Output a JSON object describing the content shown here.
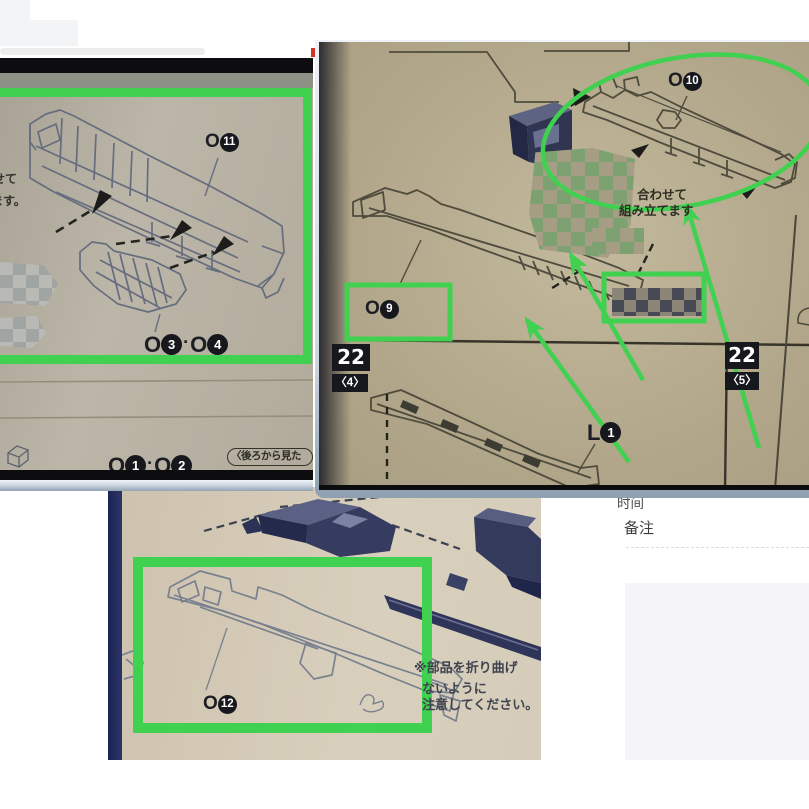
{
  "annotation_color": "#3fd14f",
  "page_bg": {
    "left_column": {
      "emoji_icon": "☺",
      "send_label": "发送讯",
      "shortcut_label": "按 Sh"
    },
    "right_column": {
      "time_label": "时间",
      "remark_label": "备注"
    }
  },
  "left_panel": {
    "o11_label": {
      "prefix": "O",
      "num": "11"
    },
    "o34_label": {
      "p1": "O",
      "n1": "3",
      "sep": "·",
      "p2": "O",
      "n2": "4"
    },
    "o12_pair_label": {
      "p1": "O",
      "n1": "1",
      "sep": "·",
      "p2": "O",
      "n2": "2"
    },
    "rear_view_label": "〈後ろから見た",
    "jp_fragment_1": "せて",
    "jp_fragment_2": "ます。"
  },
  "right_panel": {
    "o10_label": {
      "prefix": "O",
      "num": "10"
    },
    "o9_label": {
      "prefix": "O",
      "num": "9"
    },
    "l1_label": {
      "prefix": "L",
      "num": "1"
    },
    "assemble_note_line1": "合わせて",
    "assemble_note_line2": "組み立てます",
    "step_4": {
      "num": "22",
      "sub": "〈4〉"
    },
    "step_5": {
      "num": "22",
      "sub": "〈5〉"
    }
  },
  "bottom_panel": {
    "o12_label": {
      "prefix": "O",
      "num": "12"
    },
    "caution_line1": "※部品を折り曲げ",
    "caution_line2": "ないように",
    "caution_line3": "注意してください。"
  }
}
